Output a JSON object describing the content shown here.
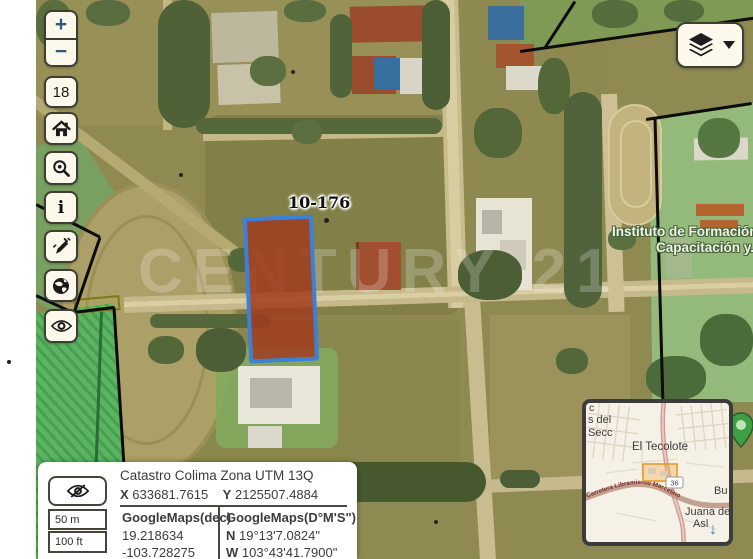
{
  "controls": {
    "zoom_in": "+",
    "zoom_out": "−",
    "zoom_level": "18",
    "info_glyph": "i",
    "icons": {
      "home": "home-icon",
      "search": "zoom-search-icon",
      "measure": "measure-edit-icon",
      "globe": "globe-icon",
      "eye": "eye-icon",
      "layers": "layers-icon",
      "caret": "caret-down-icon",
      "eye_off": "eye-off-icon"
    }
  },
  "watermark": {
    "text": "CENTURY 21"
  },
  "parcel": {
    "label": "10-176",
    "outline_color": "#3d80d8",
    "fill_color": "#a03c1e"
  },
  "labels": {
    "instituto_line1": "Instituto de Formación",
    "instituto_line2": "Capacitación y.",
    "edge_line1": "va d",
    "edge_line2": "ima"
  },
  "marker": {
    "color": "#3f9f45"
  },
  "panel": {
    "title": "Catastro Colima Zona UTM 13Q",
    "x_label": "X",
    "x_value": "633681.7615",
    "y_label": "Y",
    "y_value": "2125507.4884",
    "dec_header": "GoogleMaps(dec)",
    "dec_lat": "19.218634",
    "dec_lon": "-103.728275",
    "dms_header": "GoogleMaps(D°M'S\")",
    "dms_lat_prefix": "N",
    "dms_lat": "19°13'7.0824\"",
    "dms_lon_prefix": "W",
    "dms_lon": "103°43'41.7900\"",
    "scale_metric": "50 m",
    "scale_imperial": "100 ft"
  },
  "minimap": {
    "place": "El Tecolote",
    "road_ref": "36",
    "road_name": "Carretera Libramiento Marcelino",
    "label_c": "c",
    "label_sdel": "s del",
    "label_secc": "Secc",
    "label_bu": "Bu",
    "label_juana": "Juana de",
    "label_asl": "Asl",
    "collapse_icon": "↓",
    "extent_color": "#df9c2f"
  }
}
